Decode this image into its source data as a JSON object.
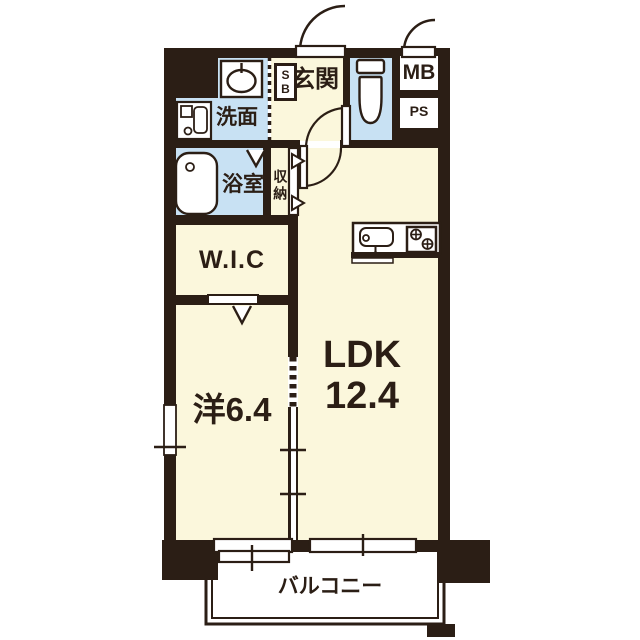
{
  "floorplan": {
    "unit_labels": {
      "entrance": "玄関",
      "shoe_box_line1": "S",
      "shoe_box_line2": "B",
      "washroom": "洗面",
      "bathroom": "浴室",
      "storage": "収納",
      "meter_box": "MB",
      "pipe_space": "PS",
      "walk_in_closet": "W.I.C",
      "western_room": "洋6.4",
      "ldk_name": "LDK",
      "ldk_size": "12.4",
      "balcony": "バルコニー"
    },
    "colors": {
      "wall": "#2B1E15",
      "room_floor": "#FBF7DC",
      "wet_area": "#C8E1F3",
      "background": "#FFFFFF"
    },
    "icons": [
      "washing-machine-icon",
      "vanity-sink-icon",
      "bathtub-icon",
      "toilet-icon",
      "kitchen-sink-icon",
      "stove-icon",
      "door-swing-icon",
      "folding-door-icon",
      "sliding-window-icon"
    ]
  }
}
